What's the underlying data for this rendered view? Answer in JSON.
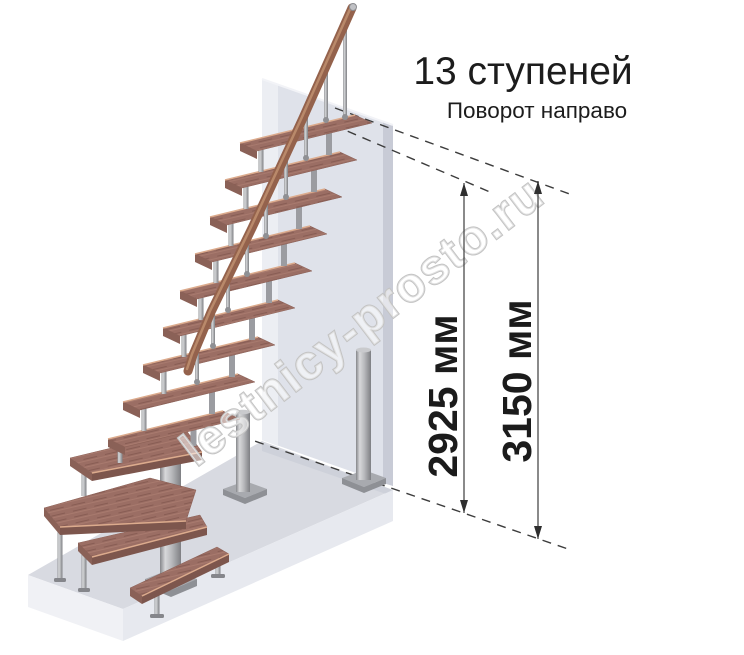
{
  "header": {
    "title": "13 ступеней",
    "subtitle": "Поворот направо"
  },
  "dimensions": {
    "stair_height": {
      "value": 2925,
      "unit": "мм",
      "label": "2925 мм"
    },
    "total_height": {
      "value": 3150,
      "unit": "мм",
      "label": "3150 мм"
    }
  },
  "watermark": {
    "text": "lestnicy-prosto.ru"
  },
  "stair": {
    "steps": 13,
    "turn": "направо",
    "straight_treads": 9,
    "winder_treads": 3,
    "entry_treads": 1
  },
  "colors": {
    "background": "#ffffff",
    "tread_top": "#9b6e64",
    "tread_face": "#7d564d",
    "tread_edge_highlight": "#dcab8d",
    "handrail": "#94624c",
    "metal": "#aeafb3",
    "wall": "#dfe2ea",
    "wall_edge": "#c8cbd6",
    "floor": "#d8dae1",
    "dimension_line": "#3c3c3c",
    "text": "#1c1c1c",
    "watermark_outline": "#c3c3c3"
  }
}
